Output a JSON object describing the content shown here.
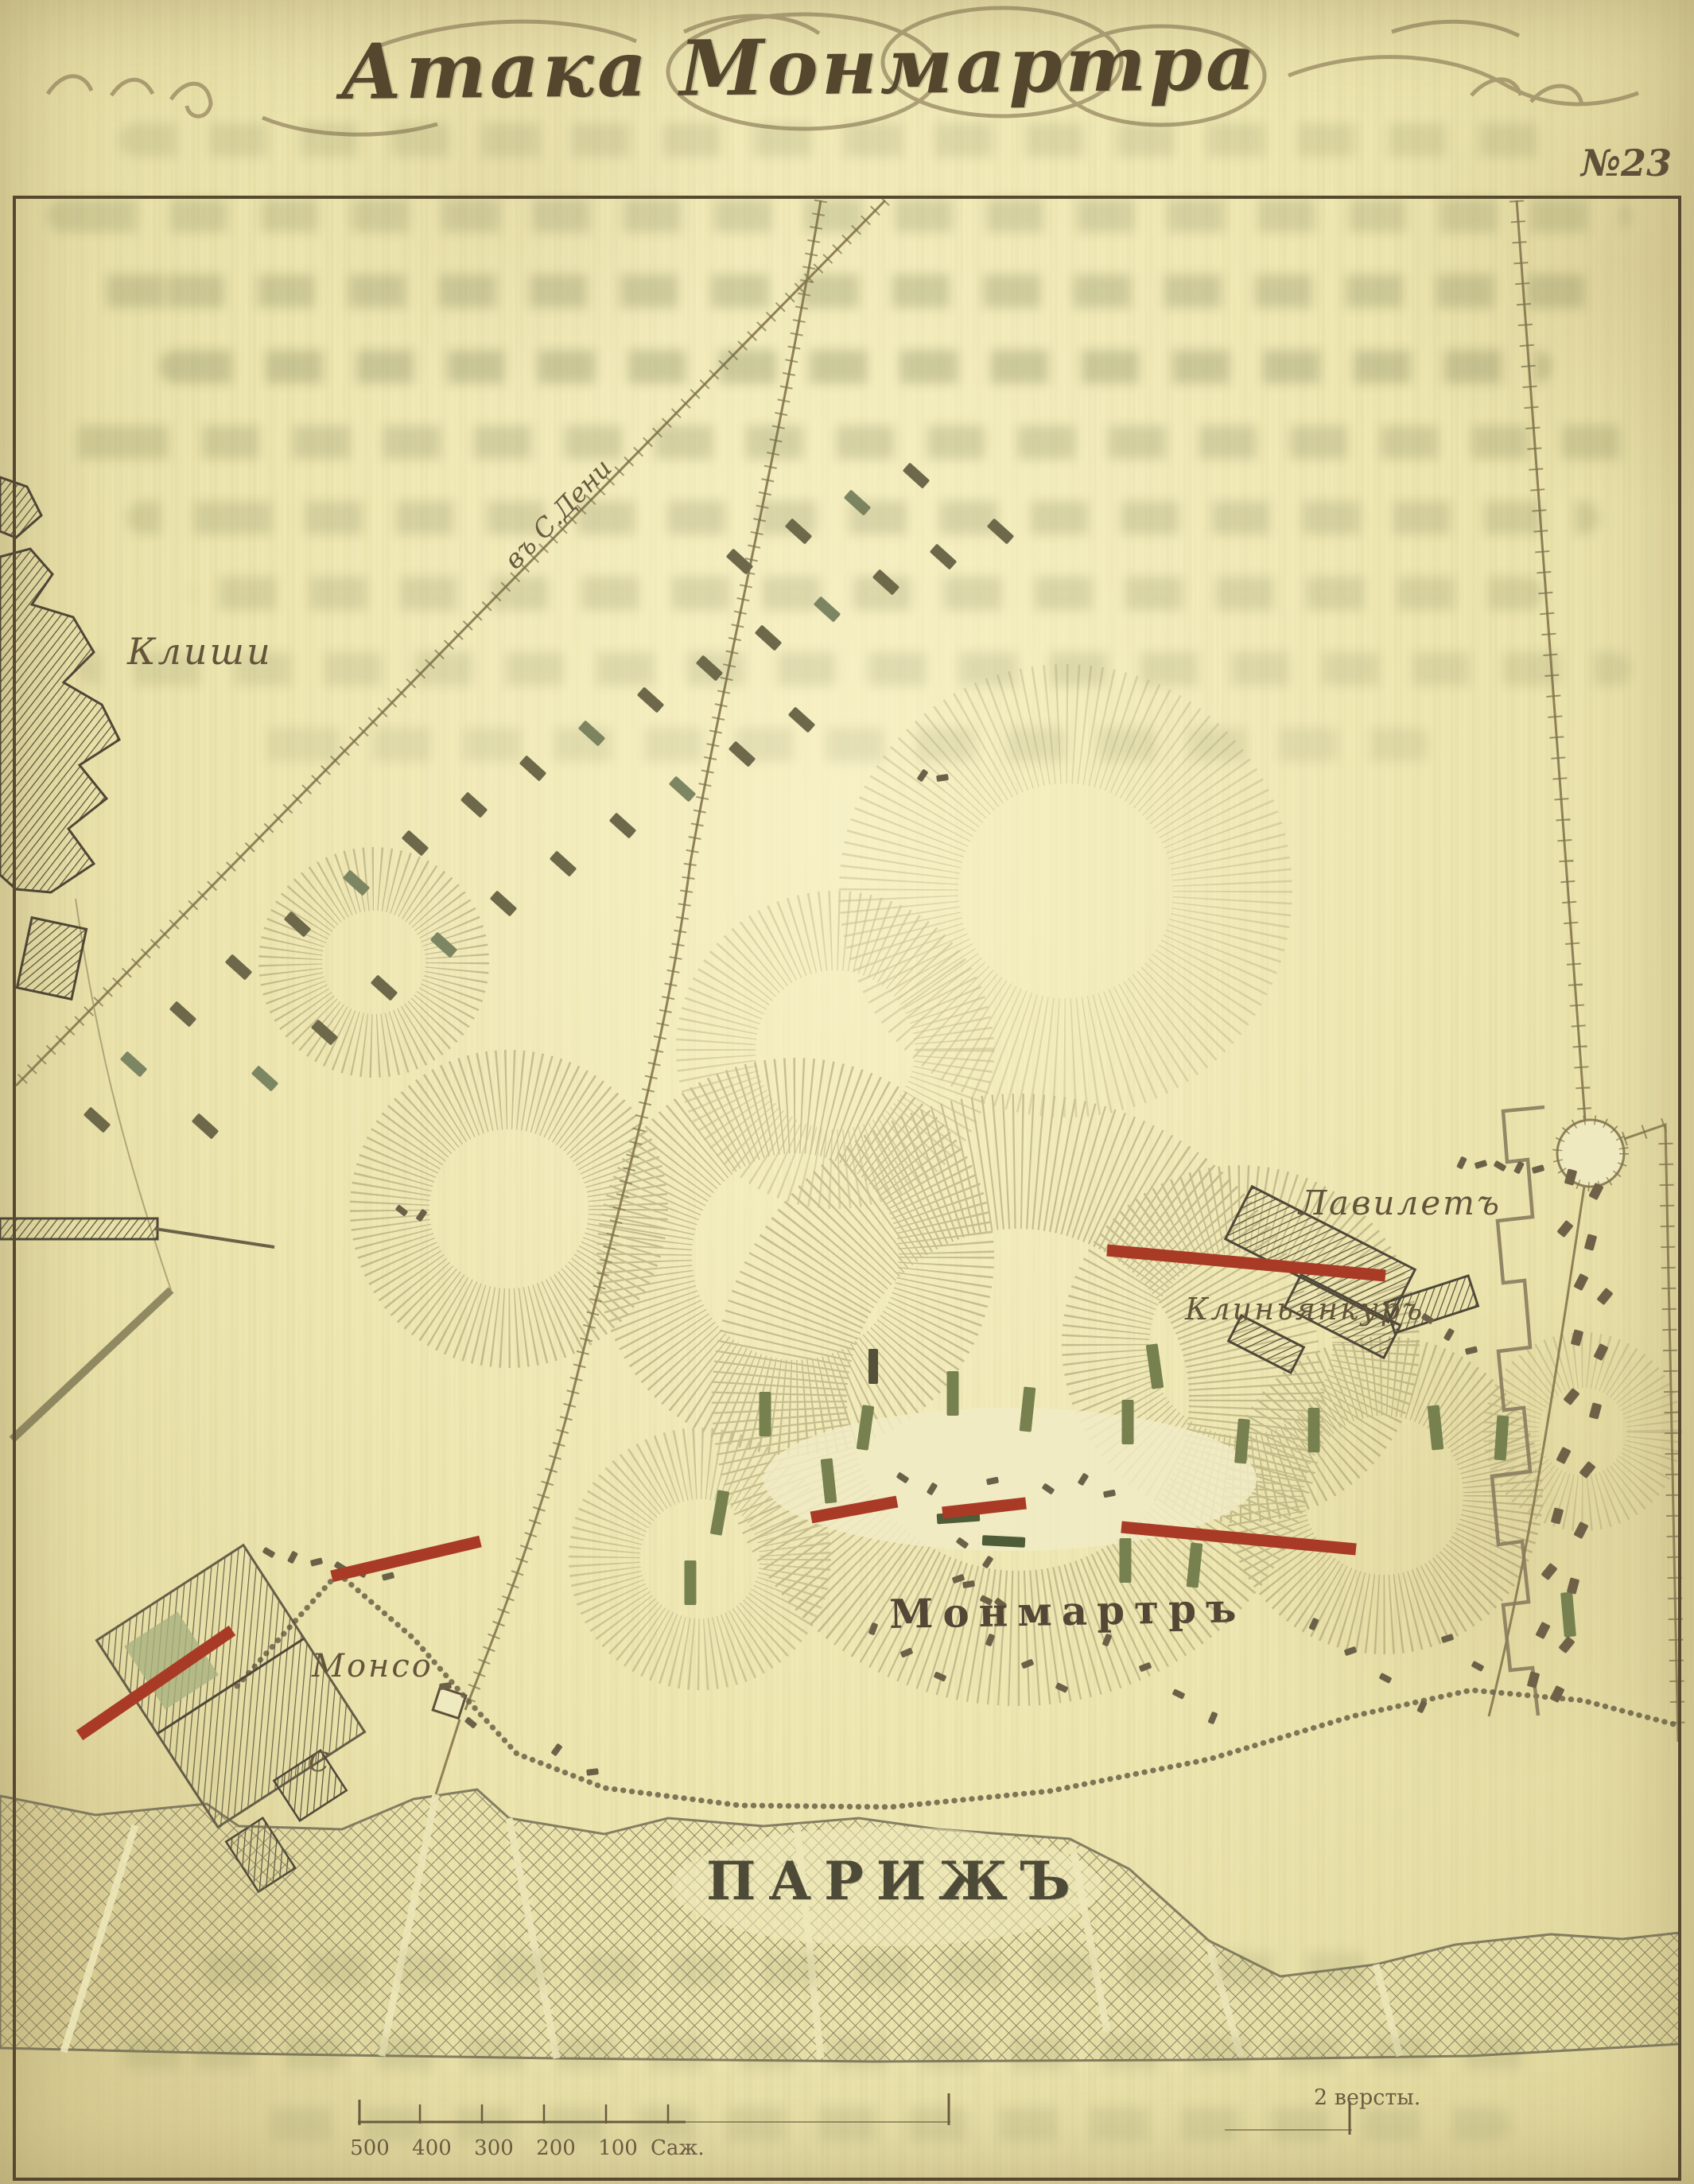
{
  "map": {
    "plate_number": "№23",
    "title": "Атака Монмартра",
    "labels": {
      "clichy": "Клиши",
      "st_denis_road": "въ С.Дени",
      "la_villette": "Лавилетъ",
      "clignancourt": "Клиньянкуръ",
      "montmartre": "Монмартръ",
      "monceau": "Монсо",
      "paris": "ПАРИЖЪ",
      "c_mark": "С"
    },
    "scale": {
      "numbers": [
        "500",
        "400",
        "300",
        "200",
        "100"
      ],
      "unit": "Саж.",
      "versts": "2 версты."
    },
    "colors": {
      "paper": "#ece4ad",
      "ink": "#5b4c34",
      "red_line": "#a93b26",
      "green_troop": "#76814f",
      "dark_green": "#4e5c38",
      "dark_troop": "#6d684a",
      "sage_troop": "#7d8662",
      "small_mark": "#6b6148",
      "house": "#6e6148",
      "hachure": "#9a9166"
    },
    "marks": {
      "infantry_dark": [
        [
          1258,
          668
        ],
        [
          1186,
          700
        ],
        [
          1114,
          732
        ],
        [
          966,
          802
        ],
        [
          892,
          840
        ],
        [
          818,
          880
        ],
        [
          670,
          966
        ],
        [
          596,
          1012
        ],
        [
          522,
          1060
        ],
        [
          374,
          1162
        ],
        [
          300,
          1216
        ],
        [
          230,
          1275
        ],
        [
          122,
          1408
        ],
        [
          1008,
          905
        ],
        [
          933,
          948
        ],
        [
          783,
          1038
        ],
        [
          708,
          1086
        ],
        [
          633,
          1136
        ],
        [
          483,
          1242
        ],
        [
          408,
          1298
        ],
        [
          258,
          1416
        ],
        [
          1152,
          598
        ],
        [
          1004,
          668
        ],
        [
          930,
          706
        ]
      ],
      "infantry_sage": [
        [
          1040,
          766
        ],
        [
          744,
          922
        ],
        [
          448,
          1110
        ],
        [
          168,
          1338
        ],
        [
          858,
          992
        ],
        [
          558,
          1188
        ],
        [
          333,
          1356
        ],
        [
          1078,
          632
        ]
      ],
      "green_bars": [
        [
          962,
          1778,
          0
        ],
        [
          1088,
          1795,
          8
        ],
        [
          1042,
          1862,
          -6
        ],
        [
          1198,
          1752,
          0
        ],
        [
          1292,
          1772,
          6
        ],
        [
          1418,
          1788,
          0
        ],
        [
          1452,
          1718,
          -8
        ],
        [
          1562,
          1812,
          5
        ],
        [
          1652,
          1798,
          0
        ],
        [
          1805,
          1795,
          -6
        ],
        [
          1888,
          1808,
          4
        ],
        [
          905,
          1902,
          10
        ],
        [
          868,
          1990,
          0
        ],
        [
          1415,
          1962,
          0
        ],
        [
          1502,
          1968,
          6
        ],
        [
          1972,
          2030,
          -5
        ]
      ],
      "green_horiz": [
        [
          1205,
          1908,
          -4
        ],
        [
          1262,
          1938,
          3
        ]
      ],
      "red_lines": [
        [
          1392,
          1572,
          1742,
          1604
        ],
        [
          1020,
          1908,
          1128,
          1888
        ],
        [
          1185,
          1902,
          1290,
          1890
        ],
        [
          1410,
          1920,
          1705,
          1948
        ],
        [
          100,
          2182,
          292,
          2050
        ],
        [
          417,
          1982,
          604,
          1938
        ]
      ],
      "houses": [
        [
          1975,
          1480
        ],
        [
          2007,
          1498
        ],
        [
          1968,
          1545
        ],
        [
          2000,
          1562
        ],
        [
          1988,
          1612
        ],
        [
          2018,
          1630
        ],
        [
          1983,
          1682
        ],
        [
          2013,
          1700
        ],
        [
          1976,
          1756
        ],
        [
          2006,
          1774
        ],
        [
          1966,
          1830
        ],
        [
          1996,
          1848
        ],
        [
          1958,
          1906
        ],
        [
          1988,
          1924
        ],
        [
          1948,
          1976
        ],
        [
          1978,
          1994
        ],
        [
          1940,
          2050
        ],
        [
          1970,
          2068
        ],
        [
          1928,
          2112
        ],
        [
          1958,
          2130
        ]
      ],
      "small_marks": [
        [
          1098,
          2048
        ],
        [
          1140,
          2078
        ],
        [
          1182,
          2108
        ],
        [
          1245,
          2062
        ],
        [
          1292,
          2092
        ],
        [
          1335,
          2122
        ],
        [
          1392,
          2062
        ],
        [
          1440,
          2096
        ],
        [
          1482,
          2130
        ],
        [
          1525,
          2160
        ],
        [
          1205,
          1985
        ],
        [
          1240,
          2012
        ],
        [
          1652,
          2042
        ],
        [
          1698,
          2076
        ],
        [
          1742,
          2110
        ],
        [
          1788,
          2146
        ],
        [
          1820,
          2060
        ],
        [
          1858,
          2095
        ],
        [
          1838,
          1462
        ],
        [
          1862,
          1464
        ],
        [
          1886,
          1466
        ],
        [
          1910,
          1468
        ],
        [
          1934,
          1470
        ],
        [
          338,
          1952
        ],
        [
          368,
          1958
        ],
        [
          398,
          1964
        ],
        [
          428,
          1970
        ],
        [
          458,
          1976
        ],
        [
          488,
          1982
        ],
        [
          1795,
          1658
        ],
        [
          1822,
          1678
        ],
        [
          1850,
          1698
        ],
        [
          1135,
          1858
        ],
        [
          1172,
          1872
        ],
        [
          1248,
          1862
        ],
        [
          1318,
          1872
        ],
        [
          1362,
          1860
        ],
        [
          1395,
          1878
        ],
        [
          1210,
          1940
        ],
        [
          1242,
          1964
        ],
        [
          1218,
          1992
        ],
        [
          1258,
          2016
        ],
        [
          1160,
          975
        ],
        [
          1185,
          978
        ],
        [
          505,
          1522
        ],
        [
          530,
          1528
        ],
        [
          560,
          2120
        ],
        [
          592,
          2166
        ],
        [
          700,
          2200
        ],
        [
          745,
          2228
        ]
      ],
      "dark_vertical": [
        [
          1098,
          1718
        ]
      ]
    }
  }
}
